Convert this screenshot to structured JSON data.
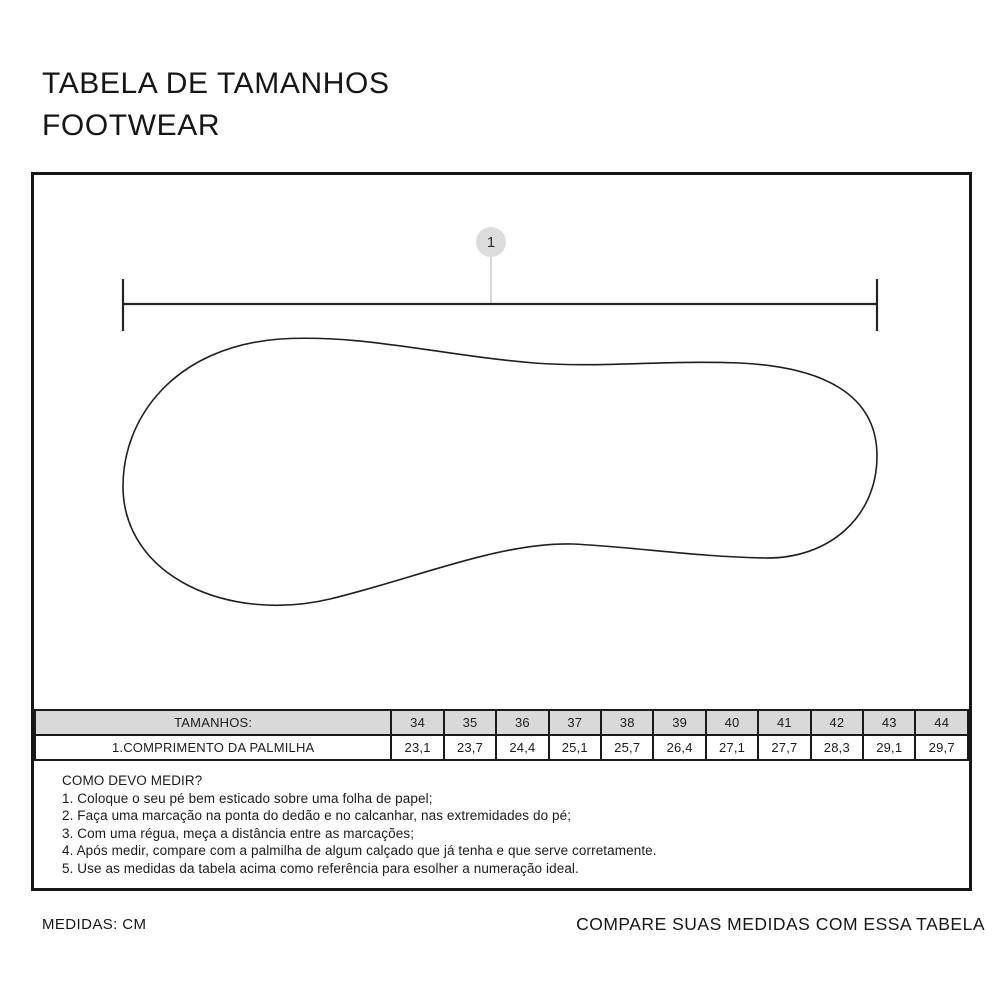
{
  "title": {
    "line1": "TABELA DE TAMANHOS",
    "line2": "FOOTWEAR"
  },
  "diagram": {
    "marker_label": "1",
    "illustration": "insole-outline-top-view",
    "dimension": "insole-length-dimension-line"
  },
  "size_table": {
    "header_label": "TAMANHOS:",
    "row_label": "1.COMPRIMENTO DA PALMILHA",
    "sizes": [
      "34",
      "35",
      "36",
      "37",
      "38",
      "39",
      "40",
      "41",
      "42",
      "43",
      "44"
    ],
    "lengths": [
      "23,1",
      "23,7",
      "24,4",
      "25,1",
      "25,7",
      "26,4",
      "27,1",
      "27,7",
      "28,3",
      "29,1",
      "29,7"
    ]
  },
  "instructions": {
    "heading": "COMO DEVO MEDIR?",
    "steps": [
      "1. Coloque o seu pé bem esticado sobre uma folha de papel;",
      "2. Faça uma marcação na ponta do dedão e no calcanhar, nas extremidades do pé;",
      "3. Com uma régua, meça a distância entre as marcações;",
      "4. Após medir, compare com a palmilha de algum calçado que já tenha e que serve corretamente.",
      "5. Use as medidas da tabela acima como referência para esolher a numeração ideal."
    ]
  },
  "footer": {
    "left": "MEDIDAS: CM",
    "right": "COMPARE SUAS MEDIDAS COM ESSA TABELA"
  },
  "colors": {
    "border": "#161616",
    "table_header_bg": "#D9D9D9",
    "marker_bg": "#DCDCDC",
    "connector_line": "#D7D7D7",
    "background": "#FFFFFF"
  }
}
